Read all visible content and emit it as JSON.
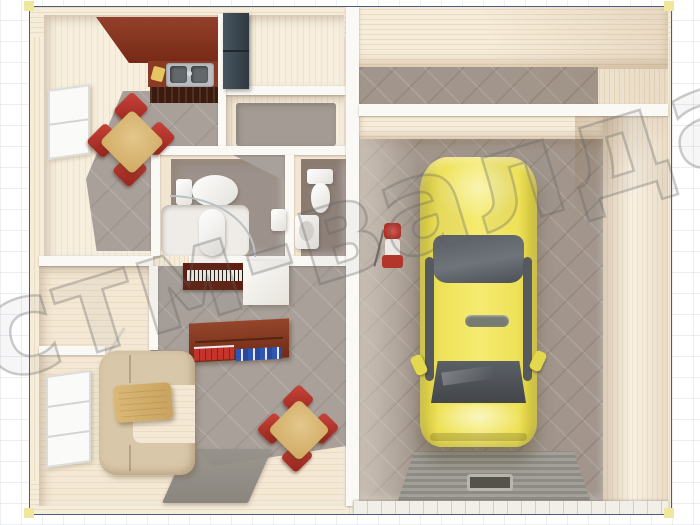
{
  "watermark": {
    "text": "стм-валда"
  },
  "frame": {
    "border_color": "#4c5b82",
    "corner_marker_color": "#efe79b",
    "page_background": "#ffffff",
    "grid_line_color": "#cdd4e0"
  },
  "palette": {
    "wall_wood": "#f3e7d2",
    "wall_wood_stripe": "#ecdcc2",
    "interior_wall_white": "#fbf9f5",
    "floor_tile_gray": "#a8a099",
    "garage_quilted_floor": "#a2968c",
    "kitchen_cabinet_red": "#8a3a24",
    "dining_chair_red": "#c0392f",
    "table_oak": "#d9b878",
    "sofa_beige": "#d9c7a9",
    "sideboard_brown": "#7c3118",
    "wardrobe_dark": "#3b4750",
    "piano_dark_red": "#5e1f12",
    "books_red": "#c4342c",
    "books_blue": "#2f55b5",
    "fixture_white": "#f6f4ef",
    "car_yellow": "#eee158",
    "car_glass": "#565b60",
    "ramp_gray": "#98958e"
  },
  "scene": {
    "type": "3d-floor-plan-top-view",
    "rooms": [
      {
        "id": "kitchen-dining",
        "objects": [
          "kitchen-upper-cabinets",
          "kitchen-counter",
          "double-sink",
          "cutting-board",
          "dining-table-oak",
          "red-chairs-x4",
          "window"
        ]
      },
      {
        "id": "entry-room",
        "objects": [
          "dark-wardrobe"
        ]
      },
      {
        "id": "hall-room",
        "objects": []
      },
      {
        "id": "bathroom-1",
        "objects": [
          "toilet",
          "corner-shower",
          "water-heater",
          "wall-sink"
        ]
      },
      {
        "id": "bathroom-2",
        "objects": [
          "toilet",
          "washbasin"
        ]
      },
      {
        "id": "boiler-room",
        "objects": [
          "door-leaf"
        ]
      },
      {
        "id": "living-room",
        "objects": [
          "piano",
          "white-cabinet",
          "sideboard-with-books",
          "corner-sofa",
          "coffee-table",
          "red-dining-set",
          "rug-runner",
          "window"
        ]
      },
      {
        "id": "storage-room",
        "objects": []
      },
      {
        "id": "garage",
        "objects": [
          "yellow-car",
          "shop-vacuum",
          "ramp-with-drain",
          "threshold"
        ]
      }
    ]
  }
}
